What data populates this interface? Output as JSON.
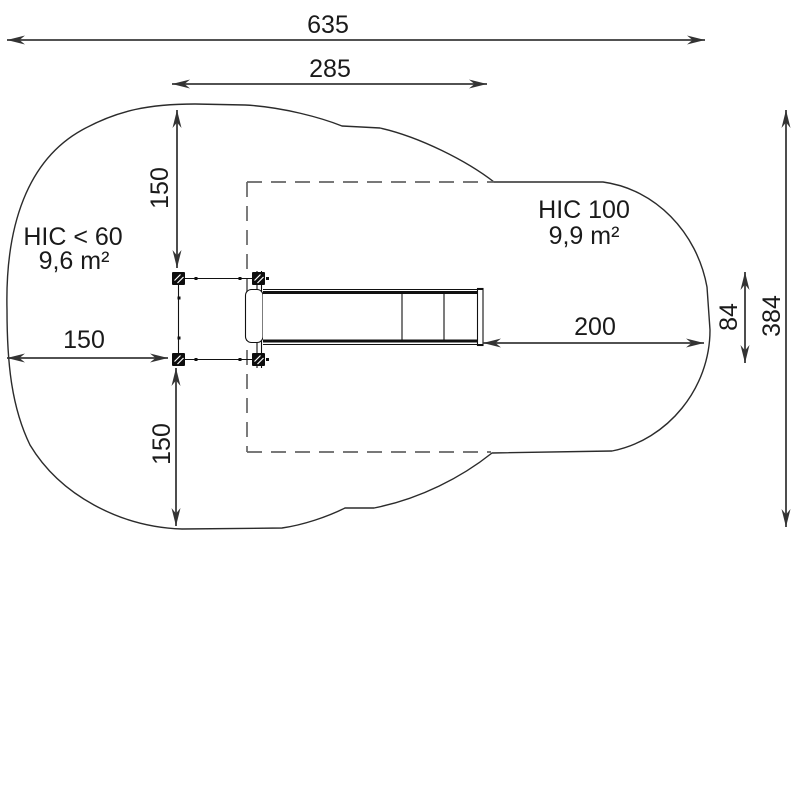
{
  "drawing": {
    "type": "playground-equipment-safety-zone-plan",
    "dimensions": {
      "total_width": "635",
      "upper_span": "285",
      "margin_top": "150",
      "margin_left": "150",
      "margin_bottom": "150",
      "slide_clearance": "200",
      "equipment_depth": "84",
      "total_depth": "384"
    },
    "zones": {
      "left": {
        "label": "HIC < 60",
        "area": "9,6 m²"
      },
      "right": {
        "label": "HIC 100",
        "area": "9,9 m²"
      }
    },
    "colors": {
      "background": "#ffffff",
      "outline": "#2b2b2b",
      "dashed_zone": "#666666",
      "dimension_lines": "#3a3a3a",
      "equipment": "#111111",
      "text": "#1a1a1a"
    }
  }
}
